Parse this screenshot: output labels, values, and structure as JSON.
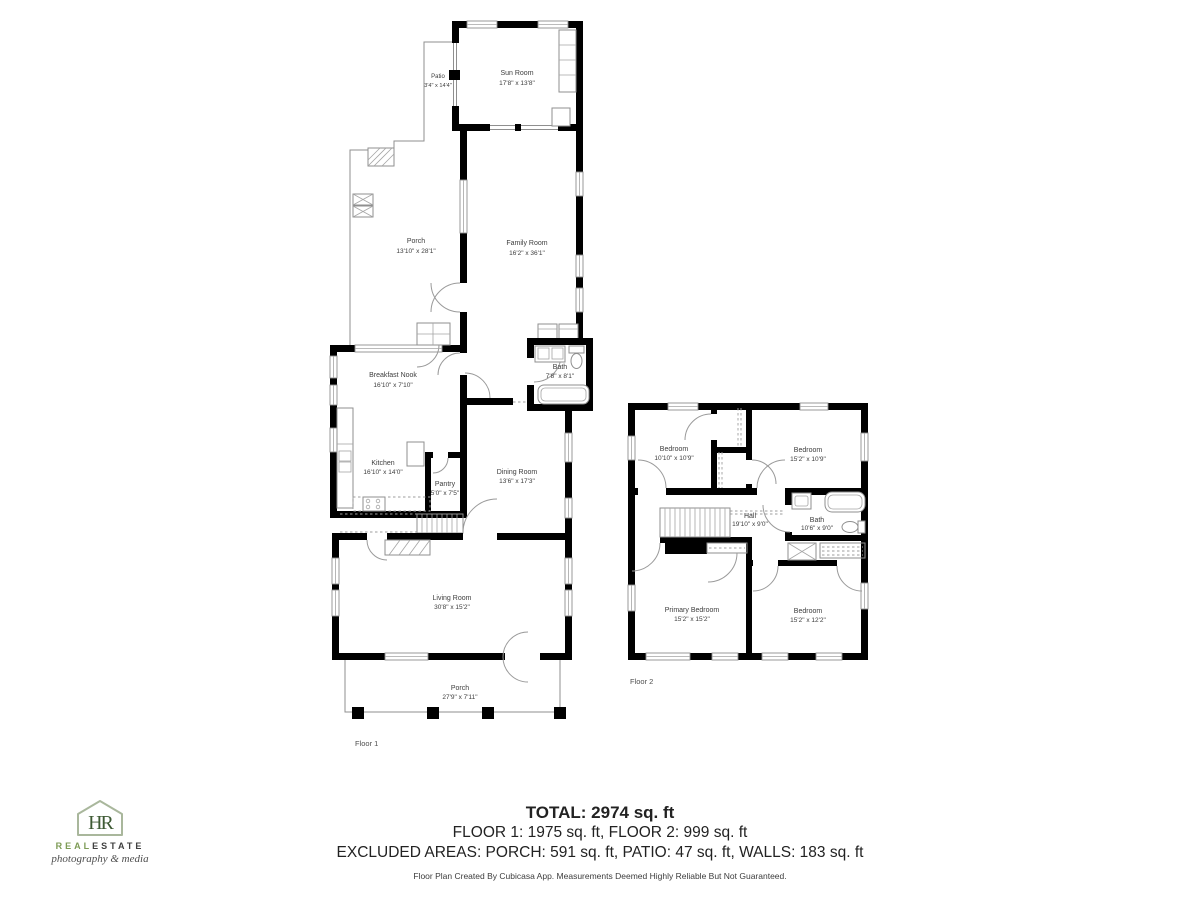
{
  "floor1": {
    "label": "Floor 1",
    "rooms": {
      "patio": {
        "name": "Patio",
        "dims": "3'4\" x 14'4\""
      },
      "sun_room": {
        "name": "Sun Room",
        "dims": "17'8\" x 13'8\""
      },
      "porch_upper": {
        "name": "Porch",
        "dims": "13'10\" x 28'1\""
      },
      "family_room": {
        "name": "Family Room",
        "dims": "16'2\" x 36'1\""
      },
      "breakfast_nook": {
        "name": "Breakfast Nook",
        "dims": "16'10\" x 7'10\""
      },
      "bath": {
        "name": "Bath",
        "dims": "7'8\" x 8'1\""
      },
      "kitchen": {
        "name": "Kitchen",
        "dims": "16'10\" x 14'0\""
      },
      "pantry": {
        "name": "Pantry",
        "dims": "5'0\" x 7'5\""
      },
      "dining_room": {
        "name": "Dining Room",
        "dims": "13'6\" x 17'3\""
      },
      "living_room": {
        "name": "Living Room",
        "dims": "30'8\" x 15'2\""
      },
      "porch_lower": {
        "name": "Porch",
        "dims": "27'9\" x 7'11\""
      }
    }
  },
  "floor2": {
    "label": "Floor 2",
    "rooms": {
      "bedroom_tl": {
        "name": "Bedroom",
        "dims": "10'10\" x 10'9\""
      },
      "bedroom_tr": {
        "name": "Bedroom",
        "dims": "15'2\" x 10'9\""
      },
      "hall": {
        "name": "Hall",
        "dims": "19'10\" x 9'0\""
      },
      "bath": {
        "name": "Bath",
        "dims": "10'6\" x 9'0\""
      },
      "primary_bedroom": {
        "name": "Primary Bedroom",
        "dims": "15'2\" x 15'2\""
      },
      "bedroom_br": {
        "name": "Bedroom",
        "dims": "15'2\" x 12'2\""
      }
    }
  },
  "summary": {
    "total": "TOTAL: 2974 sq. ft",
    "floors": "FLOOR 1: 1975 sq. ft, FLOOR 2: 999 sq. ft",
    "excluded": "EXCLUDED AREAS: PORCH: 591 sq. ft, PATIO: 47 sq. ft, WALLS: 183 sq. ft",
    "disclaimer": "Floor Plan Created By Cubicasa App. Measurements Deemed Highly Reliable But Not Guaranteed."
  },
  "logo": {
    "monogram": "HR",
    "brand_real": "REAL",
    "brand_estate": "ESTATE",
    "tagline": "photography & media",
    "colors": {
      "house_outline": "#a9b79c",
      "monogram": "#3e5a34",
      "real": "#7d9b55",
      "estate": "#3f3f3f"
    }
  },
  "colors": {
    "wall": "#000000",
    "thin_line": "#8f8f8f",
    "room_label": "#3d3d3d",
    "floor_label": "#4f4f4f"
  }
}
